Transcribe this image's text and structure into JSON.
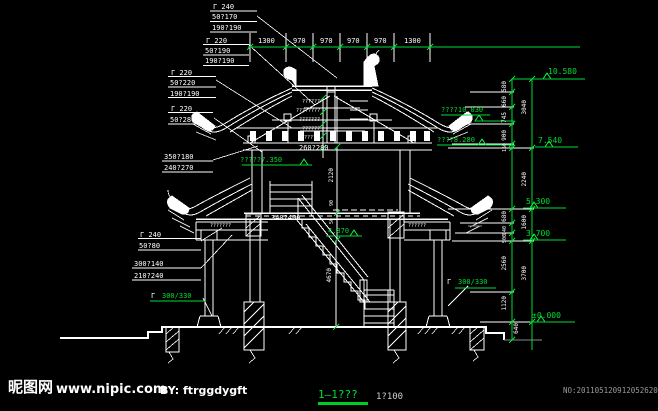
{
  "colors": {
    "background": "#000000",
    "linework": "#ffffff",
    "dimension_green": "#00dd33",
    "muted_gray": "#9a9a9a"
  },
  "top_dim_line": {
    "values": [
      "1300",
      "970",
      "970",
      "970",
      "970",
      "1300"
    ]
  },
  "left_labels": {
    "stack1": {
      "l1": "Γ  240",
      "l2": "50?170",
      "l3": "190?190"
    },
    "stack2": {
      "l1": "Γ  220",
      "l2": "50?190",
      "l3": "190?190"
    },
    "stack3": {
      "l1": "Γ  220",
      "l2": "50?220",
      "l3": "190?190"
    },
    "stack4": {
      "l1": "Γ  220",
      "l2": "50?280"
    },
    "stack5": {
      "l1": "350?180",
      "l2": "240?270"
    },
    "stack6": {
      "l1": "Γ  240",
      "l2": "50?80"
    },
    "stack7": {
      "l1": "300?140",
      "l2": "210?240"
    },
    "bracket_marker": "Γ",
    "bracket_value": "300/330"
  },
  "center_labels": {
    "upper_beam": "260?280",
    "floor_beam": "340?400",
    "stair_elevation": "4.870",
    "floor_elevation": "?????7.350",
    "tiny_note_left": "???????",
    "tiny_note_right": "??????"
  },
  "roof_notes": [
    "??????",
    "????????",
    "???????",
    "??????",
    "?????"
  ],
  "right_elevations": {
    "e10580": "10.580",
    "e10030": "????10.030",
    "e8280": "????8.280",
    "e7540": "7.540",
    "e5300": "5.300",
    "e3700": "3.700",
    "e0": "±0.000",
    "bracket_marker": "Γ",
    "bracket_value": "300/330"
  },
  "right_dims": {
    "d580": "580",
    "d660": "660",
    "d745": "745",
    "d900": "900",
    "d150": "150",
    "d3040": "3040",
    "d2240": "2240",
    "d680": "680",
    "d140": "140",
    "d500": "500",
    "d1600": "1600",
    "d2560": "2560",
    "d3700": "3700",
    "d1120": "1120",
    "d640": "640"
  },
  "center_dims": {
    "d2120": "2120",
    "d90": "90",
    "d50": "50",
    "d4670": "4670"
  },
  "footer": {
    "site_logo": "昵图网",
    "site_url": "www.nipic.com",
    "byline": "BY: ftrggdygft",
    "drawing_title": "1—1???",
    "drawing_scale": "1?100",
    "serial_no": "NO:20110512091205262000"
  }
}
